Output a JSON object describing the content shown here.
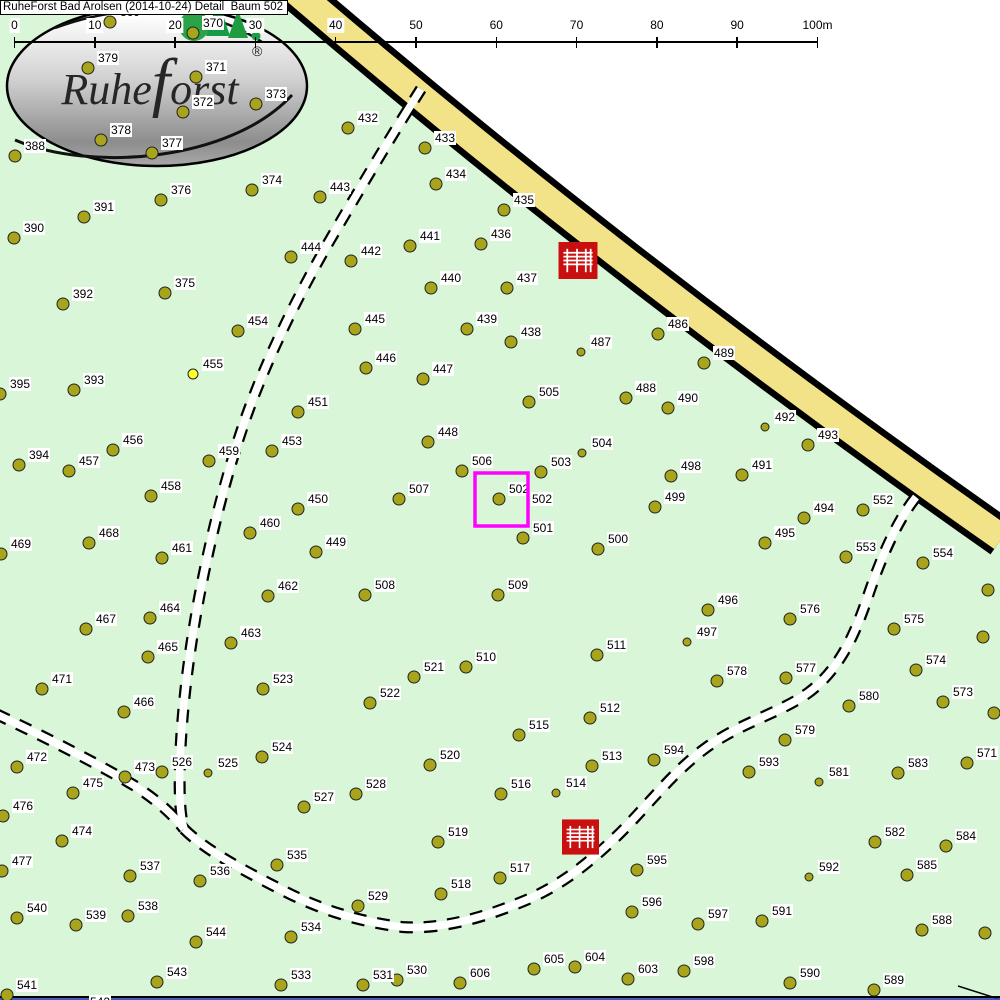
{
  "title": "RuheForst Bad Arolsen (2014-10-24) Detail  Baum 502",
  "logo": {
    "text_prefix": "Ruhe",
    "text_f": "f",
    "text_suffix": "orst",
    "registered": "®"
  },
  "scale": {
    "labels": [
      "0",
      "10",
      "20",
      "30",
      "40",
      "50",
      "60",
      "70",
      "80",
      "90",
      "100m"
    ],
    "x0": 14.5,
    "dx": 80.3,
    "y_line": 41
  },
  "highlight": {
    "selected_tree": "502",
    "extra_label": {
      "text": "502",
      "x": 531,
      "y": 492
    },
    "box": {
      "x": 475,
      "y": 473,
      "size": 53
    }
  },
  "benches": [
    {
      "x": 558,
      "y": 242,
      "w": 40,
      "h": 37
    },
    {
      "x": 562,
      "y": 817,
      "w": 37,
      "h": 40
    }
  ],
  "map": {
    "colors": {
      "forest_green": "#d9f6d9",
      "road_yellow": "#f2e389",
      "road_border": "#000000",
      "outside_white": "#ffffff",
      "tree_olive": "#a8a41c",
      "tree_highlight_yellow": "#ffff2e",
      "bench_red": "#c90f0f",
      "highlight_magenta": "#ff00ff",
      "label_bg": "#ffffff",
      "text": "#000000"
    },
    "trees": [
      [
        369,
        110,
        22,
        ""
      ],
      [
        370,
        193,
        33,
        ""
      ],
      [
        379,
        88,
        68,
        ""
      ],
      [
        371,
        196,
        77,
        ""
      ],
      [
        373,
        256,
        104,
        ""
      ],
      [
        372,
        183,
        112,
        ""
      ],
      [
        378,
        101,
        140,
        ""
      ],
      [
        377,
        152,
        153,
        ""
      ],
      [
        388,
        15,
        156,
        ""
      ],
      [
        376,
        161,
        200,
        ""
      ],
      [
        374,
        252,
        190,
        ""
      ],
      [
        391,
        84,
        217,
        ""
      ],
      [
        390,
        14,
        238,
        ""
      ],
      [
        375,
        165,
        293,
        ""
      ],
      [
        392,
        63,
        304,
        ""
      ],
      [
        454,
        238,
        331,
        ""
      ],
      [
        455,
        193,
        374,
        "y"
      ],
      [
        393,
        74,
        390,
        ""
      ],
      [
        395,
        0,
        394,
        ""
      ],
      [
        394,
        19,
        465,
        ""
      ],
      [
        456,
        113,
        450,
        ""
      ],
      [
        457,
        69,
        471,
        ""
      ],
      [
        458,
        151,
        496,
        ""
      ],
      [
        459,
        209,
        461,
        ""
      ],
      [
        453,
        272,
        451,
        ""
      ],
      [
        451,
        298,
        412,
        ""
      ],
      [
        450,
        298,
        509,
        ""
      ],
      [
        449,
        316,
        552,
        ""
      ],
      [
        460,
        250,
        533,
        ""
      ],
      [
        461,
        162,
        558,
        ""
      ],
      [
        468,
        89,
        543,
        ""
      ],
      [
        469,
        1,
        554,
        ""
      ],
      [
        462,
        268,
        596,
        ""
      ],
      [
        464,
        150,
        618,
        ""
      ],
      [
        467,
        86,
        629,
        ""
      ],
      [
        463,
        231,
        643,
        ""
      ],
      [
        465,
        148,
        657,
        ""
      ],
      [
        466,
        124,
        712,
        ""
      ],
      [
        471,
        42,
        689,
        ""
      ],
      [
        523,
        263,
        689,
        ""
      ],
      [
        472,
        17,
        767,
        ""
      ],
      [
        473,
        125,
        777,
        ""
      ],
      [
        526,
        162,
        772,
        ""
      ],
      [
        525,
        208,
        773,
        "s"
      ],
      [
        524,
        262,
        757,
        ""
      ],
      [
        475,
        73,
        793,
        ""
      ],
      [
        476,
        3,
        816,
        ""
      ],
      [
        474,
        62,
        841,
        ""
      ],
      [
        477,
        2,
        871,
        ""
      ],
      [
        537,
        130,
        876,
        ""
      ],
      [
        536,
        200,
        881,
        ""
      ],
      [
        535,
        277,
        865,
        ""
      ],
      [
        540,
        17,
        918,
        ""
      ],
      [
        539,
        76,
        925,
        ""
      ],
      [
        538,
        128,
        916,
        ""
      ],
      [
        544,
        196,
        942,
        ""
      ],
      [
        534,
        291,
        937,
        ""
      ],
      [
        543,
        157,
        982,
        ""
      ],
      [
        533,
        281,
        985,
        ""
      ],
      [
        541,
        7,
        995,
        ""
      ],
      [
        542,
        80,
        1012,
        ""
      ],
      [
        529,
        358,
        906,
        ""
      ],
      [
        527,
        304,
        807,
        ""
      ],
      [
        528,
        356,
        794,
        ""
      ],
      [
        522,
        370,
        703,
        ""
      ],
      [
        521,
        414,
        677,
        ""
      ],
      [
        510,
        466,
        667,
        ""
      ],
      [
        520,
        430,
        765,
        ""
      ],
      [
        519,
        438,
        842,
        ""
      ],
      [
        518,
        441,
        894,
        ""
      ],
      [
        517,
        500,
        878,
        ""
      ],
      [
        516,
        501,
        794,
        ""
      ],
      [
        515,
        519,
        735,
        ""
      ],
      [
        514,
        556,
        793,
        "s"
      ],
      [
        513,
        592,
        766,
        ""
      ],
      [
        512,
        590,
        718,
        ""
      ],
      [
        511,
        597,
        655,
        ""
      ],
      [
        509,
        498,
        595,
        ""
      ],
      [
        508,
        365,
        595,
        ""
      ],
      [
        507,
        399,
        499,
        ""
      ],
      [
        506,
        462,
        471,
        ""
      ],
      [
        502,
        499,
        499,
        ""
      ],
      [
        501,
        523,
        538,
        ""
      ],
      [
        503,
        541,
        472,
        ""
      ],
      [
        504,
        582,
        453,
        "s"
      ],
      [
        505,
        529,
        402,
        ""
      ],
      [
        500,
        598,
        549,
        ""
      ],
      [
        499,
        655,
        507,
        ""
      ],
      [
        498,
        671,
        476,
        ""
      ],
      [
        448,
        428,
        442,
        ""
      ],
      [
        447,
        423,
        379,
        ""
      ],
      [
        446,
        366,
        368,
        ""
      ],
      [
        445,
        355,
        329,
        ""
      ],
      [
        444,
        291,
        257,
        ""
      ],
      [
        443,
        320,
        197,
        ""
      ],
      [
        442,
        351,
        261,
        ""
      ],
      [
        441,
        410,
        246,
        ""
      ],
      [
        440,
        431,
        288,
        ""
      ],
      [
        439,
        467,
        329,
        ""
      ],
      [
        438,
        511,
        342,
        ""
      ],
      [
        437,
        507,
        288,
        ""
      ],
      [
        436,
        481,
        244,
        ""
      ],
      [
        435,
        504,
        210,
        ""
      ],
      [
        434,
        436,
        184,
        ""
      ],
      [
        433,
        425,
        148,
        ""
      ],
      [
        432,
        348,
        128,
        ""
      ],
      [
        486,
        658,
        334,
        ""
      ],
      [
        487,
        581,
        352,
        "s"
      ],
      [
        489,
        704,
        363,
        ""
      ],
      [
        488,
        626,
        398,
        ""
      ],
      [
        490,
        668,
        408,
        ""
      ],
      [
        492,
        765,
        427,
        "s"
      ],
      [
        493,
        808,
        445,
        ""
      ],
      [
        491,
        742,
        475,
        ""
      ],
      [
        494,
        804,
        518,
        ""
      ],
      [
        495,
        765,
        543,
        ""
      ],
      [
        552,
        863,
        510,
        ""
      ],
      [
        553,
        846,
        557,
        ""
      ],
      [
        554,
        923,
        563,
        ""
      ],
      [
        575,
        894,
        629,
        ""
      ],
      [
        574,
        916,
        670,
        ""
      ],
      [
        573,
        943,
        702,
        ""
      ],
      [
        571,
        967,
        763,
        ""
      ],
      [
        583,
        898,
        773,
        ""
      ],
      [
        576,
        790,
        619,
        ""
      ],
      [
        496,
        708,
        610,
        ""
      ],
      [
        497,
        687,
        642,
        "s"
      ],
      [
        578,
        717,
        681,
        ""
      ],
      [
        577,
        786,
        678,
        ""
      ],
      [
        580,
        849,
        706,
        ""
      ],
      [
        579,
        785,
        740,
        ""
      ],
      [
        594,
        654,
        760,
        ""
      ],
      [
        593,
        749,
        772,
        ""
      ],
      [
        581,
        819,
        782,
        "s"
      ],
      [
        595,
        637,
        870,
        ""
      ],
      [
        582,
        875,
        842,
        ""
      ],
      [
        584,
        946,
        846,
        ""
      ],
      [
        592,
        809,
        877,
        "s"
      ],
      [
        585,
        907,
        875,
        ""
      ],
      [
        596,
        632,
        912,
        ""
      ],
      [
        597,
        698,
        924,
        ""
      ],
      [
        591,
        762,
        921,
        ""
      ],
      [
        588,
        922,
        930,
        ""
      ],
      [
        603,
        628,
        979,
        ""
      ],
      [
        598,
        684,
        971,
        ""
      ],
      [
        590,
        790,
        983,
        ""
      ],
      [
        589,
        874,
        990,
        ""
      ],
      [
        604,
        575,
        967,
        ""
      ],
      [
        605,
        534,
        969,
        ""
      ],
      [
        606,
        460,
        983,
        ""
      ],
      [
        530,
        397,
        980,
        ""
      ],
      [
        531,
        363,
        985,
        ""
      ],
      [
        null,
        988,
        590,
        "n"
      ],
      [
        null,
        983,
        637,
        "n"
      ],
      [
        null,
        994,
        713,
        "n"
      ],
      [
        null,
        985,
        933,
        "n"
      ]
    ]
  }
}
